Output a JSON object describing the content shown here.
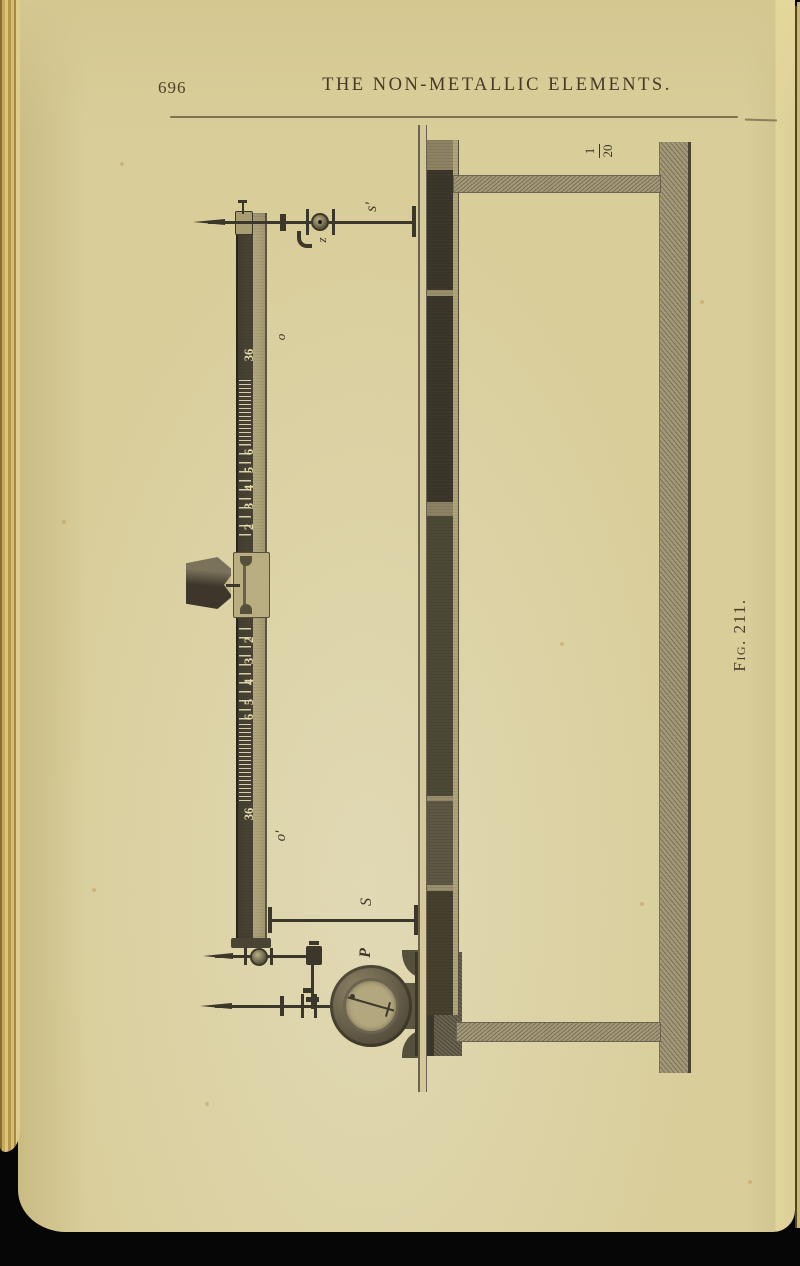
{
  "page": {
    "number": "696",
    "running_title": "THE NON-METALLIC ELEMENTS.",
    "caption": "Fig. 211."
  },
  "figure": {
    "scale_fraction": {
      "numerator": "1",
      "denominator": "20"
    },
    "labels": {
      "s_prime": "s'",
      "z": "z",
      "o": "o",
      "o_prime": "o'",
      "s": "S",
      "p": "P"
    },
    "scale_labels": [
      {
        "text": "36"
      },
      {
        "text": "6"
      },
      {
        "text": "5"
      },
      {
        "text": "4"
      },
      {
        "text": "3"
      },
      {
        "text": "2"
      },
      {
        "text": "1"
      },
      {
        "text": "2"
      },
      {
        "text": "3"
      },
      {
        "text": "4"
      },
      {
        "text": "5"
      },
      {
        "text": "6"
      },
      {
        "text": "36"
      }
    ]
  },
  "colors": {
    "paper": "#e9dda6",
    "ink": "#3b372a",
    "page_edge_gold": "#c9a95c",
    "background": "#060606"
  }
}
